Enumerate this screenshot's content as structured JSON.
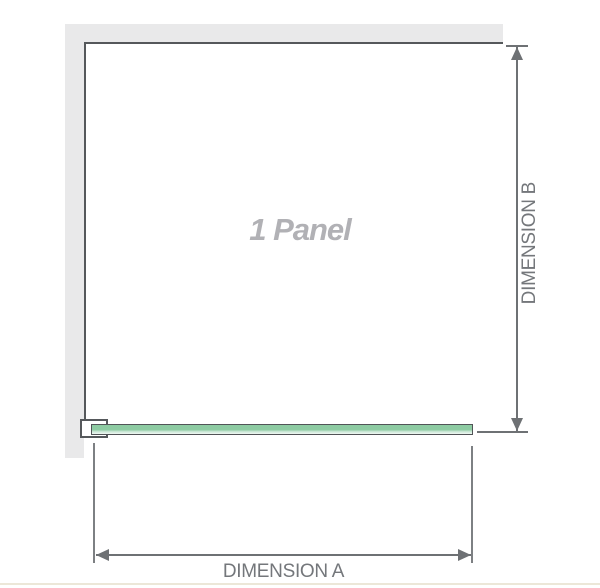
{
  "diagram": {
    "panel_label": "1 Panel",
    "dimension_a": {
      "label": "DIMENSION A"
    },
    "dimension_b": {
      "label": "DIMENSION B"
    }
  },
  "colors": {
    "wall-gray": "#e9e9ea",
    "panel-outline": "#55585b",
    "dim-line": "#6e7174",
    "ext-line": "#7d8083",
    "label-gray": "#74777b",
    "panel-label-gray": "#b1b1b5",
    "glass-green": "#8dcba2",
    "glass-green-light": "#cde8d8",
    "glass-border": "#515457",
    "bracket-fill": "#ffffff",
    "divider-cream": "#ece7d8"
  }
}
